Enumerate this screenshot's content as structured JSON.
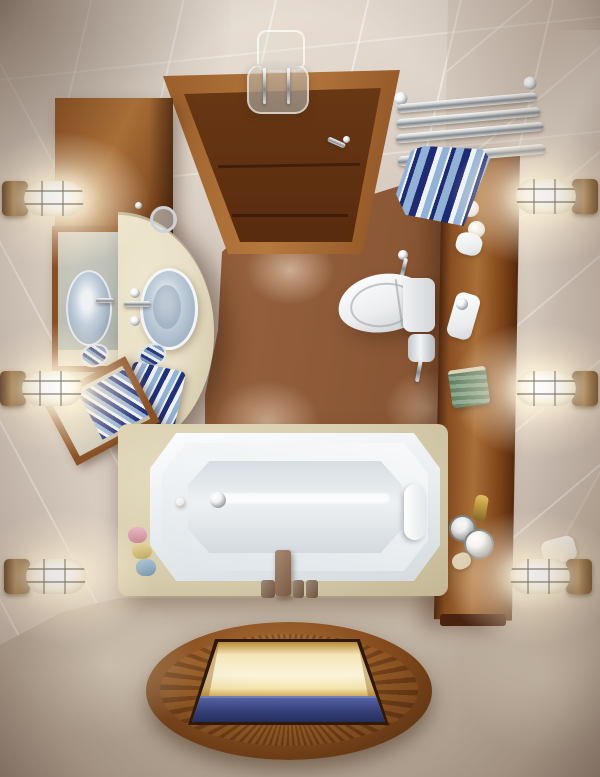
{
  "scene": {
    "title": "Top-down view of a small bathroom interior (photorealistic render)",
    "objects": {
      "walls": "beige marble-tiled walls",
      "floor": "beige tiled floor",
      "inner_floor": "brown tiled wet-area floor",
      "door": "dark wood entry door seen from above",
      "door_handle": "chrome door handle",
      "ceiling_lamp": "glass and chrome ceiling lamp",
      "towel_rack": "chrome wall towel rack",
      "rack_towel": "blue and white striped towel on rack",
      "vanity_cabinet": "wall-hung wood storage cabinet",
      "wall_mirror": "wood-framed wall mirror reflecting the sink",
      "tilted_mirror": "tilted wood-framed mirror leaning on vanity",
      "counter": "cream stone vanity counter with curved edge",
      "vessel_sink": "round glass vessel sink",
      "sink_faucet": "chrome sink faucet with cross handles",
      "tumbler": "glass tumbler on counter",
      "soap_dish_1": "striped soap dish",
      "soap_dish_2": "striped soap dish",
      "counter_towel": "striped towel on counter",
      "toilet": "white toilet seen from above",
      "toilet_tank": "toilet cistern",
      "toilet_paper": "toilet paper roll on holder",
      "sprayer": "chrome shattaf sprayer",
      "shelf": "vertical wood shelf plank with toiletries",
      "shelf_jars": "white cosmetic jars",
      "shelf_dish": "white soap dish",
      "shelf_tray": "white amenity tray with pump",
      "green_box": "green striped box of towels",
      "gold_bottle": "small gold bottle",
      "metal_jars": "round metal jars",
      "soap_bar": "cream soap bar",
      "tub_deck": "cream stone bathtub deck",
      "bathtub": "white rectangular bathtub with cut corners",
      "headrest": "white bath pillow",
      "drain": "chrome drain fitting",
      "tub_faucet": "bronze deck-mounted tub faucet with handles",
      "bath_bottles": "pink, yellow and blue bath bottles",
      "deck_cloth": "white cloth beside tub deck",
      "floor_window": "oval wood-rimmed floor opening glowing gold with blue water below",
      "wall_lights": "six caged cylindrical glass wall sconces"
    },
    "counts": {
      "wall_lights_left": 3,
      "wall_lights_right": 3,
      "bath_bottles": 3
    }
  },
  "colors": {
    "wall": "#d7cbc0",
    "wallHi": "#eee6dc",
    "wallShade": "#b9aca0",
    "floorBeige": "#ccbfb0",
    "grout": "#ebe3d6",
    "brownFloor": "#8c5839",
    "brownDark": "#5f3418",
    "wood": "#8a4f22",
    "woodHi": "#a96f38",
    "woodDark": "#54290e",
    "doorWood": "#6b3a16",
    "frameWood": "#9a5e2c",
    "cream": "#e9e0c8",
    "creamDeck": "#d8cdae",
    "tubWhite": "#f4f6f7",
    "tubShade": "#ccd3d8",
    "glass": "#9fb2c4",
    "chromeHi": "#f2f3f4",
    "chromeLo": "#8d9296",
    "bronze": "#b08a5a",
    "towelNavy": "#1d2b72",
    "towelBlue": "#92b1d6",
    "towelWhite": "#eef3f9",
    "glowWarm": "#fff3d8",
    "goldGlow": "#f6e7b0",
    "water": "#34407e",
    "green": "#6c8c70",
    "gold": "#c09b42"
  }
}
